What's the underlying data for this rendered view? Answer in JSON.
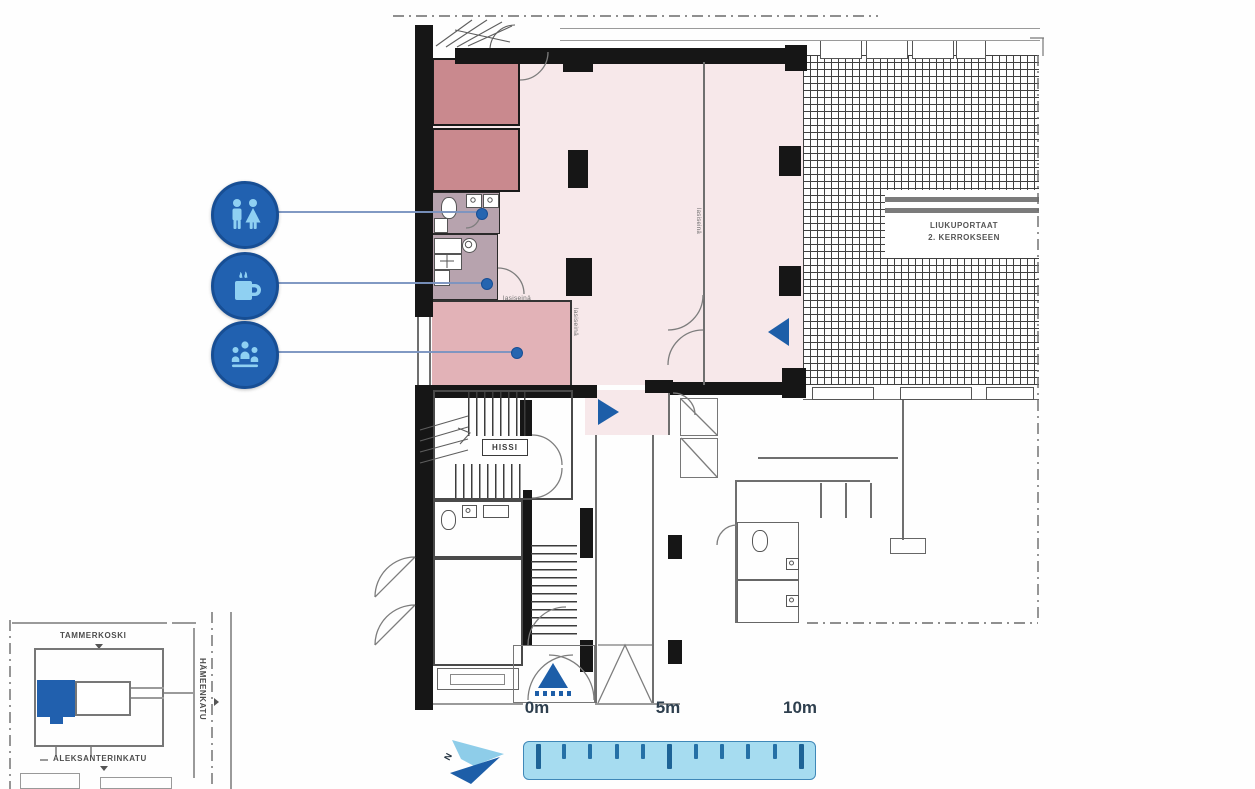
{
  "plan": {
    "labels": {
      "elevator": "HISSI",
      "escalator_line1": "LIUKUPORTAAT",
      "escalator_line2": "2. KERROKSEEN",
      "glass_wall_top": "lasiseinä",
      "glass_wall_right": "lasiseinä",
      "glass_wall_mid": "lasiseinä"
    },
    "markers": {
      "side_entrance": "arrow-right",
      "mall_entrance": "arrow-left",
      "main_entrance": "arrow-up"
    }
  },
  "callouts": {
    "restroom": {
      "icon": "restroom-icon"
    },
    "coffee": {
      "icon": "coffee-icon"
    },
    "meeting": {
      "icon": "meeting-icon"
    }
  },
  "minimap": {
    "street_top": "TAMMERKOSKI",
    "street_right": "HÄMEENKATU",
    "street_bottom": "ALEKSANTERINKATU"
  },
  "scalebar": {
    "label_0": "0m",
    "label_5": "5m",
    "label_10": "10m"
  },
  "north_label": "N",
  "colors": {
    "icon_circle": "#2161b0",
    "icon_glyph": "#8fd0f2",
    "accent_blue": "#1d5ea8",
    "space_light": "#f7e8ea",
    "room_medium": "#e2b2b7",
    "room_dark": "#c9898e",
    "room_service": "#b7a3ae",
    "ruler_fill": "#a6dcf0",
    "ruler_border": "#3f88b8",
    "ruler_tick": "#1d6396"
  }
}
